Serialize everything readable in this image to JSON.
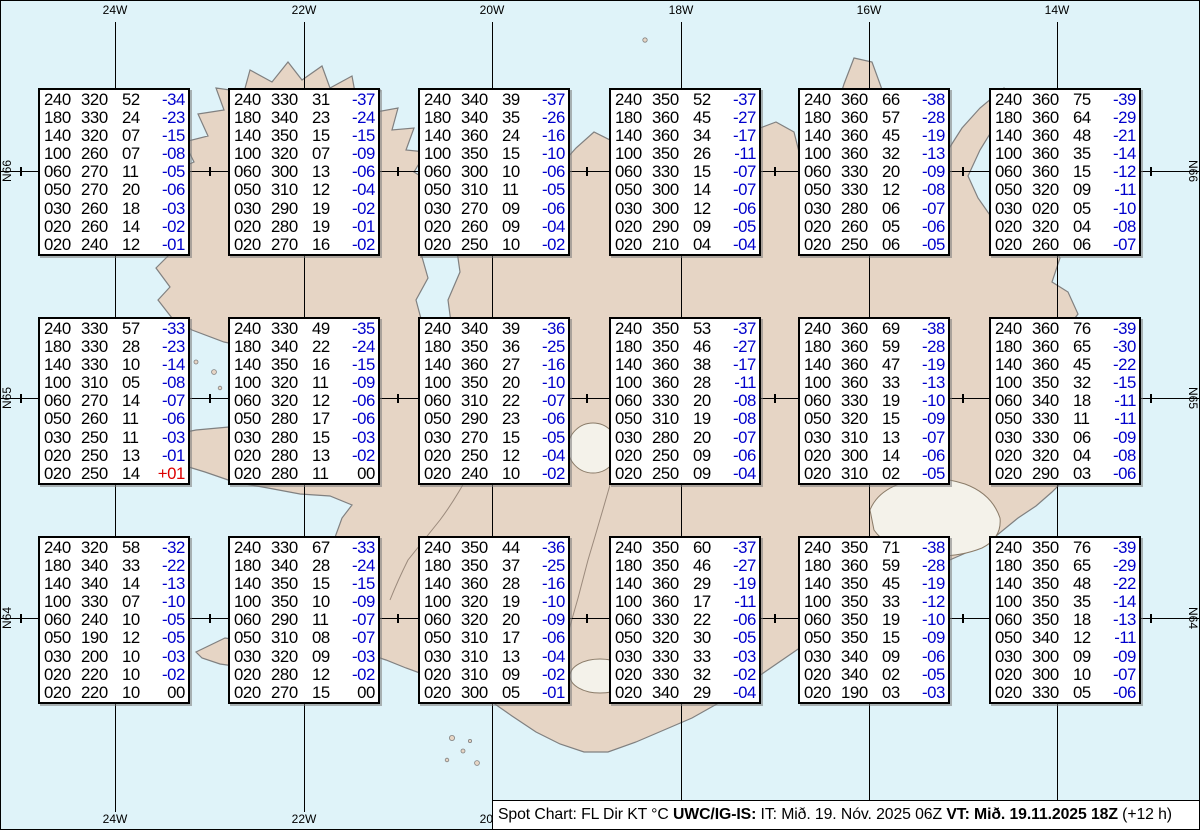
{
  "title": "Spot Chart Iceland",
  "grid": {
    "meridians": [
      {
        "label": "24W",
        "x": 115
      },
      {
        "label": "22W",
        "x": 304
      },
      {
        "label": "20W",
        "x": 492
      },
      {
        "label": "18W",
        "x": 681
      },
      {
        "label": "16W",
        "x": 869
      },
      {
        "label": "14W",
        "x": 1057
      }
    ],
    "parallels": [
      {
        "label": "N66",
        "y": 171
      },
      {
        "label": "N65",
        "y": 398
      },
      {
        "label": "N64",
        "y": 618
      }
    ],
    "tick_xs": [
      21,
      210,
      398,
      587,
      775,
      963,
      1151
    ]
  },
  "columns_legend": [
    "FL",
    "Dir",
    "KT",
    "°C"
  ],
  "spots": [
    {
      "row": 0,
      "col": 0,
      "rows": [
        [
          "240",
          "320",
          "52",
          "-34"
        ],
        [
          "180",
          "330",
          "24",
          "-23"
        ],
        [
          "140",
          "320",
          "07",
          "-15"
        ],
        [
          "100",
          "260",
          "07",
          "-08"
        ],
        [
          "060",
          "270",
          "11",
          "-05"
        ],
        [
          "050",
          "270",
          "20",
          "-06"
        ],
        [
          "030",
          "260",
          "18",
          "-03"
        ],
        [
          "020",
          "260",
          "14",
          "-02"
        ],
        [
          "020",
          "240",
          "12",
          "-01"
        ]
      ]
    },
    {
      "row": 0,
      "col": 1,
      "rows": [
        [
          "240",
          "330",
          "31",
          "-37"
        ],
        [
          "180",
          "340",
          "23",
          "-24"
        ],
        [
          "140",
          "350",
          "15",
          "-15"
        ],
        [
          "100",
          "320",
          "07",
          "-09"
        ],
        [
          "060",
          "300",
          "13",
          "-06"
        ],
        [
          "050",
          "310",
          "12",
          "-04"
        ],
        [
          "030",
          "290",
          "19",
          "-02"
        ],
        [
          "020",
          "280",
          "19",
          "-01"
        ],
        [
          "020",
          "270",
          "16",
          "-02"
        ]
      ]
    },
    {
      "row": 0,
      "col": 2,
      "rows": [
        [
          "240",
          "340",
          "39",
          "-37"
        ],
        [
          "180",
          "340",
          "35",
          "-26"
        ],
        [
          "140",
          "360",
          "24",
          "-16"
        ],
        [
          "100",
          "350",
          "15",
          "-10"
        ],
        [
          "060",
          "300",
          "10",
          "-06"
        ],
        [
          "050",
          "310",
          "11",
          "-05"
        ],
        [
          "030",
          "270",
          "09",
          "-06"
        ],
        [
          "020",
          "260",
          "09",
          "-04"
        ],
        [
          "020",
          "250",
          "10",
          "-02"
        ]
      ]
    },
    {
      "row": 0,
      "col": 3,
      "rows": [
        [
          "240",
          "350",
          "52",
          "-37"
        ],
        [
          "180",
          "360",
          "45",
          "-27"
        ],
        [
          "140",
          "360",
          "34",
          "-17"
        ],
        [
          "100",
          "350",
          "26",
          "-11"
        ],
        [
          "060",
          "330",
          "15",
          "-07"
        ],
        [
          "050",
          "300",
          "14",
          "-07"
        ],
        [
          "030",
          "300",
          "12",
          "-06"
        ],
        [
          "020",
          "290",
          "09",
          "-05"
        ],
        [
          "020",
          "210",
          "04",
          "-04"
        ]
      ]
    },
    {
      "row": 0,
      "col": 4,
      "rows": [
        [
          "240",
          "360",
          "66",
          "-38"
        ],
        [
          "180",
          "360",
          "57",
          "-28"
        ],
        [
          "140",
          "360",
          "45",
          "-19"
        ],
        [
          "100",
          "360",
          "32",
          "-13"
        ],
        [
          "060",
          "330",
          "20",
          "-09"
        ],
        [
          "050",
          "330",
          "12",
          "-08"
        ],
        [
          "030",
          "280",
          "06",
          "-07"
        ],
        [
          "020",
          "260",
          "05",
          "-06"
        ],
        [
          "020",
          "250",
          "06",
          "-05"
        ]
      ]
    },
    {
      "row": 0,
      "col": 5,
      "rows": [
        [
          "240",
          "360",
          "75",
          "-39"
        ],
        [
          "180",
          "360",
          "64",
          "-29"
        ],
        [
          "140",
          "360",
          "48",
          "-21"
        ],
        [
          "100",
          "360",
          "35",
          "-14"
        ],
        [
          "060",
          "360",
          "15",
          "-12"
        ],
        [
          "050",
          "320",
          "09",
          "-11"
        ],
        [
          "030",
          "020",
          "05",
          "-10"
        ],
        [
          "020",
          "320",
          "04",
          "-08"
        ],
        [
          "020",
          "260",
          "06",
          "-07"
        ]
      ]
    },
    {
      "row": 1,
      "col": 0,
      "rows": [
        [
          "240",
          "330",
          "57",
          "-33"
        ],
        [
          "180",
          "330",
          "28",
          "-23"
        ],
        [
          "140",
          "330",
          "10",
          "-14"
        ],
        [
          "100",
          "310",
          "05",
          "-08"
        ],
        [
          "060",
          "270",
          "14",
          "-07"
        ],
        [
          "050",
          "260",
          "11",
          "-06"
        ],
        [
          "030",
          "250",
          "11",
          "-03"
        ],
        [
          "020",
          "250",
          "13",
          "-01"
        ],
        [
          "020",
          "250",
          "14",
          "+01"
        ]
      ]
    },
    {
      "row": 1,
      "col": 1,
      "rows": [
        [
          "240",
          "330",
          "49",
          "-35"
        ],
        [
          "180",
          "340",
          "22",
          "-24"
        ],
        [
          "140",
          "350",
          "16",
          "-15"
        ],
        [
          "100",
          "320",
          "11",
          "-09"
        ],
        [
          "060",
          "320",
          "12",
          "-06"
        ],
        [
          "050",
          "280",
          "17",
          "-06"
        ],
        [
          "030",
          "280",
          "15",
          "-03"
        ],
        [
          "020",
          "280",
          "13",
          "-02"
        ],
        [
          "020",
          "280",
          "11",
          "00"
        ]
      ]
    },
    {
      "row": 1,
      "col": 2,
      "rows": [
        [
          "240",
          "340",
          "39",
          "-36"
        ],
        [
          "180",
          "350",
          "36",
          "-25"
        ],
        [
          "140",
          "360",
          "27",
          "-16"
        ],
        [
          "100",
          "350",
          "20",
          "-10"
        ],
        [
          "060",
          "310",
          "22",
          "-07"
        ],
        [
          "050",
          "290",
          "23",
          "-06"
        ],
        [
          "030",
          "270",
          "15",
          "-05"
        ],
        [
          "020",
          "250",
          "12",
          "-04"
        ],
        [
          "020",
          "240",
          "10",
          "-02"
        ]
      ]
    },
    {
      "row": 1,
      "col": 3,
      "rows": [
        [
          "240",
          "350",
          "53",
          "-37"
        ],
        [
          "180",
          "350",
          "46",
          "-27"
        ],
        [
          "140",
          "360",
          "38",
          "-17"
        ],
        [
          "100",
          "360",
          "28",
          "-11"
        ],
        [
          "060",
          "330",
          "20",
          "-08"
        ],
        [
          "050",
          "310",
          "19",
          "-08"
        ],
        [
          "030",
          "280",
          "20",
          "-07"
        ],
        [
          "020",
          "250",
          "09",
          "-06"
        ],
        [
          "020",
          "250",
          "09",
          "-04"
        ]
      ]
    },
    {
      "row": 1,
      "col": 4,
      "rows": [
        [
          "240",
          "360",
          "69",
          "-38"
        ],
        [
          "180",
          "360",
          "59",
          "-28"
        ],
        [
          "140",
          "360",
          "47",
          "-19"
        ],
        [
          "100",
          "360",
          "33",
          "-13"
        ],
        [
          "060",
          "330",
          "19",
          "-10"
        ],
        [
          "050",
          "320",
          "15",
          "-09"
        ],
        [
          "030",
          "310",
          "13",
          "-07"
        ],
        [
          "020",
          "300",
          "14",
          "-06"
        ],
        [
          "020",
          "310",
          "02",
          "-05"
        ]
      ]
    },
    {
      "row": 1,
      "col": 5,
      "rows": [
        [
          "240",
          "360",
          "76",
          "-39"
        ],
        [
          "180",
          "360",
          "65",
          "-30"
        ],
        [
          "140",
          "360",
          "45",
          "-22"
        ],
        [
          "100",
          "350",
          "32",
          "-15"
        ],
        [
          "060",
          "340",
          "18",
          "-11"
        ],
        [
          "050",
          "330",
          "11",
          "-11"
        ],
        [
          "030",
          "330",
          "06",
          "-09"
        ],
        [
          "020",
          "320",
          "04",
          "-08"
        ],
        [
          "020",
          "290",
          "03",
          "-06"
        ]
      ]
    },
    {
      "row": 2,
      "col": 0,
      "rows": [
        [
          "240",
          "320",
          "58",
          "-32"
        ],
        [
          "180",
          "340",
          "33",
          "-22"
        ],
        [
          "140",
          "340",
          "14",
          "-13"
        ],
        [
          "100",
          "330",
          "07",
          "-10"
        ],
        [
          "060",
          "240",
          "10",
          "-05"
        ],
        [
          "050",
          "190",
          "12",
          "-05"
        ],
        [
          "030",
          "200",
          "10",
          "-03"
        ],
        [
          "020",
          "220",
          "10",
          "-02"
        ],
        [
          "020",
          "220",
          "10",
          "00"
        ]
      ]
    },
    {
      "row": 2,
      "col": 1,
      "rows": [
        [
          "240",
          "330",
          "67",
          "-33"
        ],
        [
          "180",
          "340",
          "28",
          "-24"
        ],
        [
          "140",
          "350",
          "15",
          "-15"
        ],
        [
          "100",
          "350",
          "10",
          "-09"
        ],
        [
          "060",
          "290",
          "11",
          "-07"
        ],
        [
          "050",
          "310",
          "08",
          "-07"
        ],
        [
          "030",
          "320",
          "09",
          "-03"
        ],
        [
          "020",
          "280",
          "12",
          "-02"
        ],
        [
          "020",
          "270",
          "15",
          "00"
        ]
      ]
    },
    {
      "row": 2,
      "col": 2,
      "rows": [
        [
          "240",
          "350",
          "44",
          "-36"
        ],
        [
          "180",
          "350",
          "37",
          "-25"
        ],
        [
          "140",
          "360",
          "28",
          "-16"
        ],
        [
          "100",
          "320",
          "19",
          "-10"
        ],
        [
          "060",
          "320",
          "20",
          "-09"
        ],
        [
          "050",
          "310",
          "17",
          "-06"
        ],
        [
          "030",
          "310",
          "13",
          "-04"
        ],
        [
          "020",
          "310",
          "09",
          "-02"
        ],
        [
          "020",
          "300",
          "05",
          "-01"
        ]
      ]
    },
    {
      "row": 2,
      "col": 3,
      "rows": [
        [
          "240",
          "350",
          "60",
          "-37"
        ],
        [
          "180",
          "350",
          "46",
          "-27"
        ],
        [
          "140",
          "360",
          "29",
          "-19"
        ],
        [
          "100",
          "360",
          "17",
          "-11"
        ],
        [
          "060",
          "330",
          "22",
          "-06"
        ],
        [
          "050",
          "320",
          "30",
          "-05"
        ],
        [
          "030",
          "330",
          "33",
          "-03"
        ],
        [
          "020",
          "330",
          "32",
          "-02"
        ],
        [
          "020",
          "340",
          "29",
          "-04"
        ]
      ]
    },
    {
      "row": 2,
      "col": 4,
      "rows": [
        [
          "240",
          "350",
          "71",
          "-38"
        ],
        [
          "180",
          "360",
          "59",
          "-28"
        ],
        [
          "140",
          "350",
          "45",
          "-19"
        ],
        [
          "100",
          "350",
          "33",
          "-12"
        ],
        [
          "060",
          "350",
          "19",
          "-10"
        ],
        [
          "050",
          "350",
          "15",
          "-09"
        ],
        [
          "030",
          "340",
          "09",
          "-06"
        ],
        [
          "020",
          "340",
          "02",
          "-05"
        ],
        [
          "020",
          "190",
          "03",
          "-03"
        ]
      ]
    },
    {
      "row": 2,
      "col": 5,
      "rows": [
        [
          "240",
          "350",
          "76",
          "-39"
        ],
        [
          "180",
          "350",
          "65",
          "-29"
        ],
        [
          "140",
          "350",
          "48",
          "-22"
        ],
        [
          "100",
          "350",
          "35",
          "-14"
        ],
        [
          "060",
          "350",
          "18",
          "-13"
        ],
        [
          "050",
          "340",
          "12",
          "-11"
        ],
        [
          "030",
          "300",
          "09",
          "-09"
        ],
        [
          "020",
          "300",
          "10",
          "-07"
        ],
        [
          "020",
          "330",
          "05",
          "-06"
        ]
      ]
    }
  ],
  "caption": {
    "segments": [
      {
        "text": "Spot Chart: FL Dir KT °C ",
        "bold": false
      },
      {
        "text": "UWC/IG-IS:",
        "bold": true
      },
      {
        "text": " IT: Mið. 19. Nóv. 2025 06Z ",
        "bold": false
      },
      {
        "text": "VT: Mið. 19.11.2025 18Z",
        "bold": true
      },
      {
        "text": " (+12 h)",
        "bold": false
      }
    ]
  },
  "colors": {
    "water": "#dff3f9",
    "land": "#e6d5c5",
    "coastline": "#808080",
    "temp_negative": "#0000cc",
    "temp_positive": "#dd0000",
    "temp_zero": "#000000",
    "grid": "#000000"
  }
}
